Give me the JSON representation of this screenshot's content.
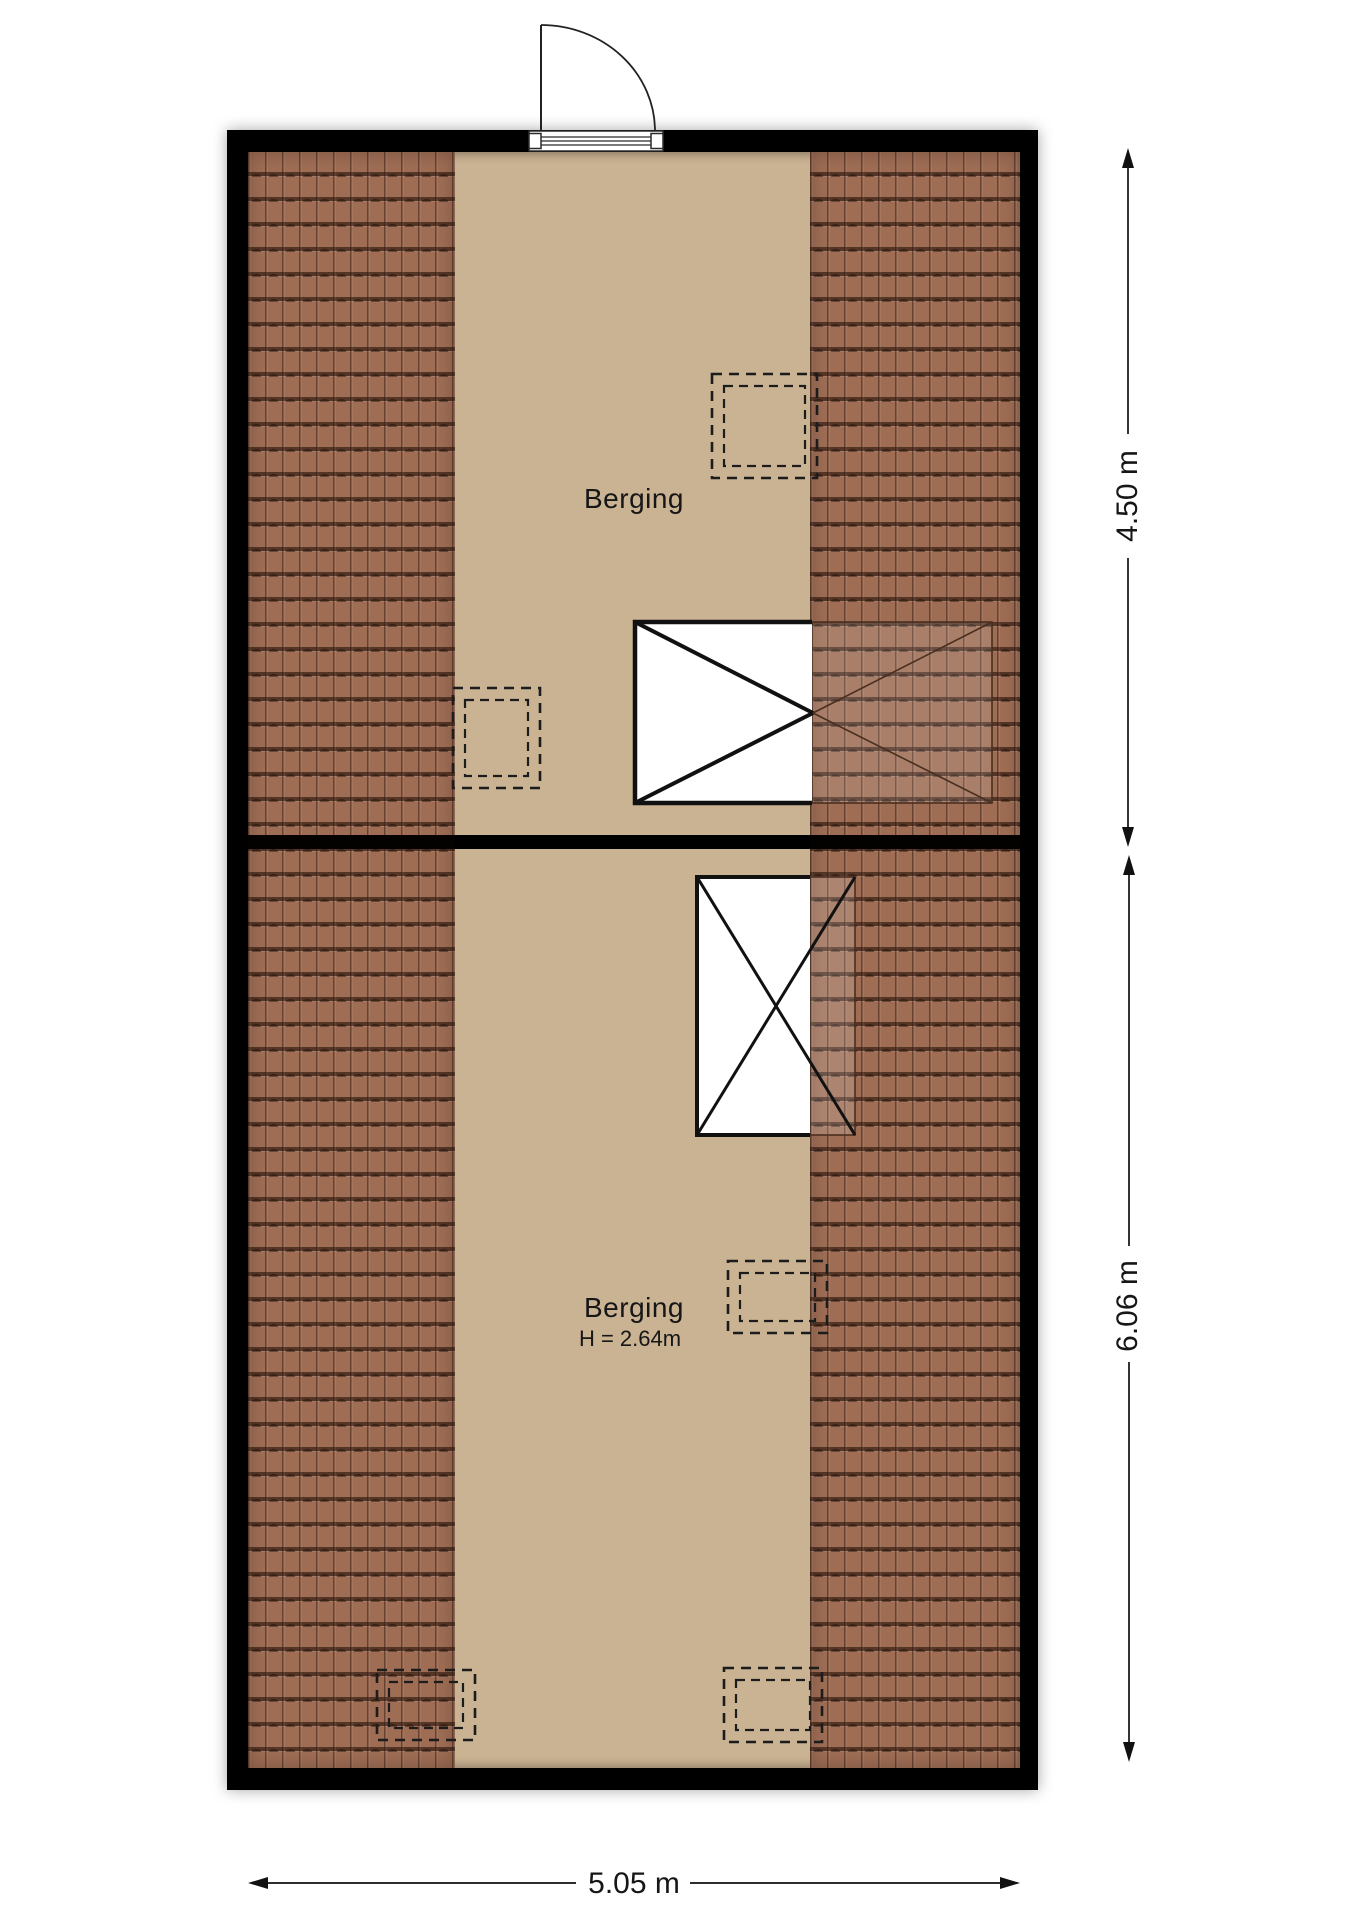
{
  "plan": {
    "type_note": "attic floor plan",
    "rooms": {
      "top": {
        "label": "Berging"
      },
      "bottom": {
        "label": "Berging",
        "height_note": "H = 2.64m"
      }
    },
    "dimensions": {
      "right_top": "4.50 m",
      "right_bottom": "6.06 m",
      "bottom": "5.05 m"
    },
    "colors": {
      "wall": "#000000",
      "floor": "#cab393",
      "roof_tile": "#9e6d54",
      "annotation": "#161616"
    }
  }
}
